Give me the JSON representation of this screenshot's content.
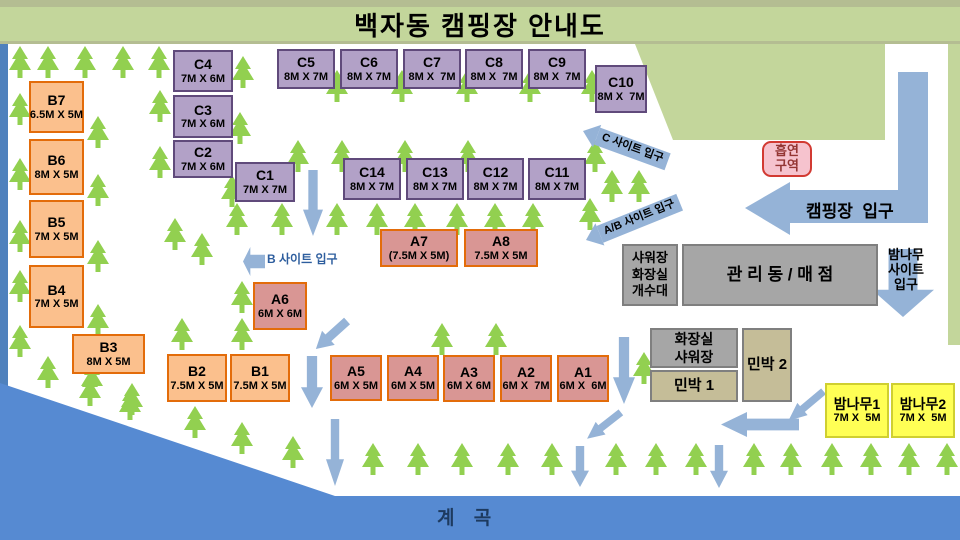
{
  "title": "백자동 캠핑장 안내도",
  "water_label": "계 곡",
  "entrances": {
    "camp": {
      "label": "캠핑장  입구"
    },
    "c_site": {
      "label": "C 사이트 입구"
    },
    "ab_site": {
      "label": "A/B 사이트 입구"
    },
    "b_site": {
      "label": "B 사이트 입구"
    },
    "bamboo": {
      "lines": [
        "밤나무",
        "사이트",
        "입구"
      ]
    }
  },
  "sites": [
    {
      "id": "b7",
      "label": "B7",
      "size": "6.5M X 5M",
      "kind": "b",
      "x": 29,
      "y": 81,
      "w": 55,
      "h": 52
    },
    {
      "id": "b6",
      "label": "B6",
      "size": "8M X 5M",
      "kind": "b",
      "x": 29,
      "y": 139,
      "w": 55,
      "h": 56
    },
    {
      "id": "b5",
      "label": "B5",
      "size": "7M X 5M",
      "kind": "b",
      "x": 29,
      "y": 200,
      "w": 55,
      "h": 58
    },
    {
      "id": "b4",
      "label": "B4",
      "size": "7M X 5M",
      "kind": "b",
      "x": 29,
      "y": 265,
      "w": 55,
      "h": 63
    },
    {
      "id": "b3",
      "label": "B3",
      "size": "8M X 5M",
      "kind": "b",
      "x": 72,
      "y": 334,
      "w": 73,
      "h": 40
    },
    {
      "id": "b2",
      "label": "B2",
      "size": "7.5M X 5M",
      "kind": "b",
      "x": 167,
      "y": 354,
      "w": 60,
      "h": 48
    },
    {
      "id": "b1",
      "label": "B1",
      "size": "7.5M X 5M",
      "kind": "b",
      "x": 230,
      "y": 354,
      "w": 60,
      "h": 48
    },
    {
      "id": "c4",
      "label": "C4",
      "size": "7M X 6M",
      "kind": "c",
      "x": 173,
      "y": 50,
      "w": 60,
      "h": 42
    },
    {
      "id": "c3",
      "label": "C3",
      "size": "7M X 6M",
      "kind": "c",
      "x": 173,
      "y": 95,
      "w": 60,
      "h": 43
    },
    {
      "id": "c2",
      "label": "C2",
      "size": "7M X 6M",
      "kind": "c",
      "x": 173,
      "y": 140,
      "w": 60,
      "h": 38
    },
    {
      "id": "c1",
      "label": "C1",
      "size": "7M X 7M",
      "kind": "c",
      "x": 235,
      "y": 162,
      "w": 60,
      "h": 40
    },
    {
      "id": "c5",
      "label": "C5",
      "size": "8M X 7M",
      "kind": "c",
      "x": 277,
      "y": 49,
      "w": 58,
      "h": 40
    },
    {
      "id": "c6",
      "label": "C6",
      "size": "8M X 7M",
      "kind": "c",
      "x": 340,
      "y": 49,
      "w": 58,
      "h": 40
    },
    {
      "id": "c7",
      "label": "C7",
      "size": "8M X  7M",
      "kind": "c",
      "x": 403,
      "y": 49,
      "w": 58,
      "h": 40
    },
    {
      "id": "c8",
      "label": "C8",
      "size": "8M X  7M",
      "kind": "c",
      "x": 465,
      "y": 49,
      "w": 58,
      "h": 40
    },
    {
      "id": "c9",
      "label": "C9",
      "size": "8M X  7M",
      "kind": "c",
      "x": 528,
      "y": 49,
      "w": 58,
      "h": 40
    },
    {
      "id": "c10",
      "label": "C10",
      "size": "8M X  7M",
      "kind": "c",
      "x": 595,
      "y": 65,
      "w": 52,
      "h": 48
    },
    {
      "id": "c14",
      "label": "C14",
      "size": "8M X 7M",
      "kind": "c",
      "x": 343,
      "y": 158,
      "w": 58,
      "h": 42
    },
    {
      "id": "c13",
      "label": "C13",
      "size": "8M X 7M",
      "kind": "c",
      "x": 406,
      "y": 158,
      "w": 58,
      "h": 42
    },
    {
      "id": "c12",
      "label": "C12",
      "size": "8M X 7M",
      "kind": "c",
      "x": 467,
      "y": 158,
      "w": 57,
      "h": 42
    },
    {
      "id": "c11",
      "label": "C11",
      "size": "8M X 7M",
      "kind": "c",
      "x": 528,
      "y": 158,
      "w": 58,
      "h": 42
    },
    {
      "id": "a7",
      "label": "A7",
      "size": "(7.5M X 5M)",
      "kind": "a",
      "x": 380,
      "y": 229,
      "w": 78,
      "h": 38
    },
    {
      "id": "a8",
      "label": "A8",
      "size": "7.5M X 5M",
      "kind": "a",
      "x": 464,
      "y": 229,
      "w": 74,
      "h": 38
    },
    {
      "id": "a6",
      "label": "A6",
      "size": "6M X 6M",
      "kind": "a",
      "x": 253,
      "y": 282,
      "w": 54,
      "h": 48
    },
    {
      "id": "a5",
      "label": "A5",
      "size": "6M X 5M",
      "kind": "a",
      "x": 330,
      "y": 355,
      "w": 52,
      "h": 46
    },
    {
      "id": "a4",
      "label": "A4",
      "size": "6M X 5M",
      "kind": "a",
      "x": 387,
      "y": 355,
      "w": 52,
      "h": 46
    },
    {
      "id": "a3",
      "label": "A3",
      "size": "6M X 6M",
      "kind": "a",
      "x": 443,
      "y": 355,
      "w": 52,
      "h": 47
    },
    {
      "id": "a2",
      "label": "A2",
      "size": "6M X  7M",
      "kind": "a",
      "x": 500,
      "y": 355,
      "w": 52,
      "h": 47
    },
    {
      "id": "a1",
      "label": "A1",
      "size": "6M X  6M",
      "kind": "a",
      "x": 557,
      "y": 355,
      "w": 52,
      "h": 47
    },
    {
      "id": "bamnamu1",
      "label": "밤나무1",
      "size": "7M X  5M",
      "kind": "y",
      "x": 825,
      "y": 383,
      "w": 64,
      "h": 55
    },
    {
      "id": "bamnamu2",
      "label": "밤나무2",
      "size": "7M X  5M",
      "kind": "y",
      "x": 891,
      "y": 383,
      "w": 64,
      "h": 55
    }
  ],
  "facilities": [
    {
      "id": "shower-toilet-sink",
      "lines": [
        "샤워장",
        "화장실",
        "개수대"
      ],
      "kind": "gray",
      "fs": 13,
      "x": 622,
      "y": 244,
      "w": 56,
      "h": 62
    },
    {
      "id": "admin-store",
      "lines": [
        "관 리 동 / 매 점"
      ],
      "kind": "gray",
      "fs": 17,
      "x": 682,
      "y": 244,
      "w": 196,
      "h": 62
    },
    {
      "id": "toilet-shower",
      "lines": [
        "화장실",
        "샤워장"
      ],
      "kind": "gray",
      "fs": 14,
      "x": 650,
      "y": 328,
      "w": 88,
      "h": 40
    },
    {
      "id": "minbak-1",
      "lines": [
        "민박 1"
      ],
      "kind": "tan",
      "fs": 15,
      "x": 650,
      "y": 370,
      "w": 88,
      "h": 32
    },
    {
      "id": "minbak-2",
      "lines": [
        "민박 2"
      ],
      "kind": "tan",
      "fs": 15,
      "x": 742,
      "y": 328,
      "w": 50,
      "h": 74
    },
    {
      "id": "smoking-area",
      "lines": [
        "흡연",
        "구역"
      ],
      "kind": "smoke",
      "fs": 13,
      "x": 762,
      "y": 141,
      "w": 50,
      "h": 36
    }
  ],
  "trees": [
    [
      8,
      46
    ],
    [
      36,
      46
    ],
    [
      73,
      46
    ],
    [
      111,
      46
    ],
    [
      147,
      46
    ],
    [
      231,
      56
    ],
    [
      325,
      70
    ],
    [
      390,
      70
    ],
    [
      455,
      70
    ],
    [
      518,
      70
    ],
    [
      580,
      70
    ],
    [
      8,
      93
    ],
    [
      8,
      158
    ],
    [
      8,
      220
    ],
    [
      8,
      270
    ],
    [
      8,
      325
    ],
    [
      86,
      116
    ],
    [
      86,
      174
    ],
    [
      86,
      240
    ],
    [
      86,
      304
    ],
    [
      80,
      362
    ],
    [
      120,
      383
    ],
    [
      148,
      90
    ],
    [
      148,
      146
    ],
    [
      163,
      218
    ],
    [
      190,
      233
    ],
    [
      228,
      112
    ],
    [
      220,
      175
    ],
    [
      286,
      140
    ],
    [
      330,
      140
    ],
    [
      393,
      140
    ],
    [
      456,
      140
    ],
    [
      583,
      140
    ],
    [
      600,
      170
    ],
    [
      627,
      170
    ],
    [
      578,
      198
    ],
    [
      225,
      203
    ],
    [
      270,
      203
    ],
    [
      325,
      203
    ],
    [
      365,
      203
    ],
    [
      403,
      203
    ],
    [
      445,
      203
    ],
    [
      483,
      203
    ],
    [
      521,
      203
    ],
    [
      230,
      281
    ],
    [
      230,
      318
    ],
    [
      170,
      318
    ],
    [
      430,
      323
    ],
    [
      484,
      323
    ],
    [
      632,
      352
    ],
    [
      36,
      356
    ],
    [
      78,
      374
    ],
    [
      118,
      388
    ],
    [
      183,
      406
    ],
    [
      230,
      422
    ],
    [
      281,
      436
    ],
    [
      361,
      443
    ],
    [
      406,
      443
    ],
    [
      450,
      443
    ],
    [
      496,
      443
    ],
    [
      540,
      443
    ],
    [
      604,
      443
    ],
    [
      644,
      443
    ],
    [
      684,
      443
    ],
    [
      742,
      443
    ],
    [
      779,
      443
    ],
    [
      820,
      443
    ],
    [
      859,
      443
    ],
    [
      897,
      443
    ],
    [
      935,
      443
    ]
  ],
  "arrows": [
    {
      "t": "down",
      "x": 303,
      "y": 170,
      "w": 20,
      "h": 66
    },
    {
      "t": "down",
      "x": 301,
      "y": 356,
      "w": 22,
      "h": 52
    },
    {
      "t": "down",
      "x": 326,
      "y": 419,
      "w": 18,
      "h": 67
    },
    {
      "t": "down",
      "x": 613,
      "y": 337,
      "w": 22,
      "h": 67
    },
    {
      "t": "down",
      "x": 571,
      "y": 446,
      "w": 18,
      "h": 41
    },
    {
      "t": "down",
      "x": 710,
      "y": 445,
      "w": 18,
      "h": 43
    },
    {
      "t": "down",
      "x": 872,
      "y": 249,
      "w": 62,
      "h": 68
    },
    {
      "t": "down",
      "x": 322,
      "y": 314,
      "w": 19,
      "h": 42,
      "r": 48
    },
    {
      "t": "down",
      "x": 596,
      "y": 404,
      "w": 16,
      "h": 43,
      "r": 52
    },
    {
      "t": "down",
      "x": 798,
      "y": 383,
      "w": 16,
      "h": 46,
      "r": 50
    },
    {
      "t": "left",
      "x": 721,
      "y": 412,
      "w": 78,
      "h": 25
    },
    {
      "t": "left",
      "x": 243,
      "y": 247,
      "w": 22,
      "h": 29
    }
  ],
  "colors": {
    "header_green": "#c3d69b",
    "header_trim": "#b4bd92",
    "area_green": "#c3d69b",
    "tree_green": "#92d050",
    "arrow_blue": "#95b3d7",
    "water_blue": "#568ad2",
    "edge_blue": "#4f81bd",
    "site_a_fill": "#d99694",
    "site_b_fill": "#fbc08d",
    "site_c_fill": "#b2a1c7",
    "site_ab_border": "#e36c0a",
    "site_c_border": "#604a7b",
    "facility_gray": "#a6a6a6",
    "minbak_tan": "#c5bd98",
    "bamboo_yellow": "#ffff55",
    "smoking_fill": "#f6c3ce",
    "smoking_border": "#d23a32",
    "smoking_text": "#943634",
    "water_label_text": "#1d3a5f",
    "b_site_label_text": "#2e5e9e"
  }
}
